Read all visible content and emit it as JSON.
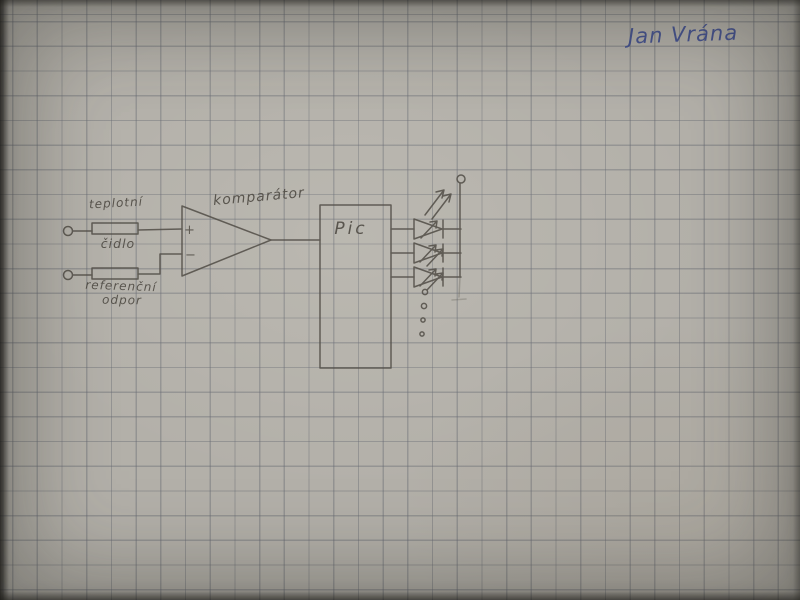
{
  "photo": {
    "description": "hand-drawn circuit schematic in pencil on squared graph paper",
    "signature": "Jan Vrána"
  },
  "colors": {
    "paper": "#b3b0a9",
    "grid_line": "#6a6c76",
    "pencil": "#514d46",
    "ink_blue": "#3c4b8f"
  },
  "schematic": {
    "labels": {
      "sensor_line1": "teplotní",
      "sensor_line2": "čidlo",
      "reference_line1": "referenční",
      "reference_line2": "odpor",
      "comparator": "komparátor",
      "mcu": "Pic",
      "plus": "+",
      "minus": "−"
    },
    "components": [
      {
        "name": "input-terminal-top",
        "type": "open-terminal"
      },
      {
        "name": "resistor-temperature-sensor",
        "type": "resistor",
        "label": "teplotní čidlo"
      },
      {
        "name": "input-terminal-bottom",
        "type": "open-terminal"
      },
      {
        "name": "resistor-reference",
        "type": "resistor",
        "label": "referenční odpor"
      },
      {
        "name": "comparator",
        "type": "op-amp-triangle",
        "label": "komparátor"
      },
      {
        "name": "mcu-block",
        "type": "rectangle",
        "label": "Pic"
      },
      {
        "name": "led",
        "type": "led-with-emission-arrows",
        "count": 3
      },
      {
        "name": "more-outputs-ellipsis",
        "type": "dots",
        "count": 4
      },
      {
        "name": "supply-terminal",
        "type": "open-terminal"
      }
    ]
  }
}
